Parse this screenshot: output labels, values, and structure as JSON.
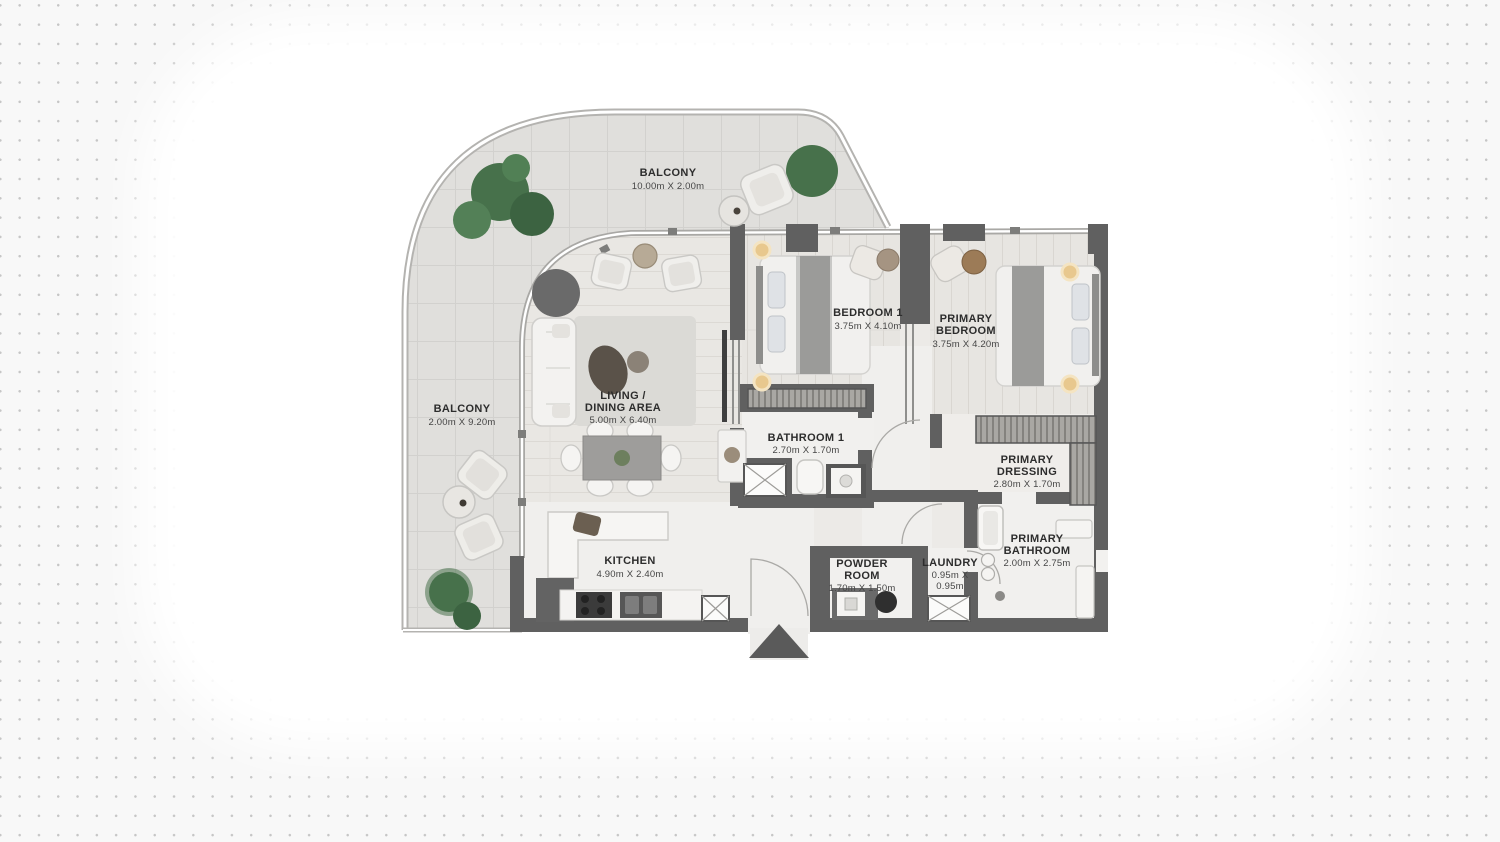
{
  "page": {
    "background_color": "#f8f8f8",
    "dot_color": "#c6c6c6",
    "canvas_color": "#ffffff"
  },
  "plan": {
    "wall_color": "#606060",
    "balcony_floor_color": "#e0dfdc",
    "interior_floor_color": "#eceae7",
    "marble_floor_color": "#f0efed",
    "plant_color": "#47714b",
    "lamp_glow_color": "#e8c88e",
    "rooms": [
      {
        "id": "balcony-top",
        "lines": [
          "BALCONY",
          "10.00m X 2.00m"
        ]
      },
      {
        "id": "balcony-left",
        "lines": [
          "BALCONY",
          "2.00m X 9.20m"
        ]
      },
      {
        "id": "living-dining",
        "lines": [
          "LIVING /",
          "DINING AREA",
          "5.00m X 6.40m"
        ]
      },
      {
        "id": "bedroom-1",
        "lines": [
          "BEDROOM 1",
          "3.75m X 4.10m"
        ]
      },
      {
        "id": "primary-bedroom",
        "lines": [
          "PRIMARY",
          "BEDROOM",
          "3.75m X 4.20m"
        ]
      },
      {
        "id": "bathroom-1",
        "lines": [
          "BATHROOM 1",
          "2.70m X 1.70m"
        ]
      },
      {
        "id": "primary-dressing",
        "lines": [
          "PRIMARY",
          "DRESSING",
          "2.80m X 1.70m"
        ]
      },
      {
        "id": "primary-bathroom",
        "lines": [
          "PRIMARY",
          "BATHROOM",
          "2.00m X 2.75m"
        ]
      },
      {
        "id": "kitchen",
        "lines": [
          "KITCHEN",
          "4.90m X 2.40m"
        ]
      },
      {
        "id": "powder-room",
        "lines": [
          "POWDER",
          "ROOM",
          "1.70m X 1.50m"
        ]
      },
      {
        "id": "laundry",
        "lines": [
          "LAUNDRY",
          "0.95m X",
          "0.95m"
        ]
      }
    ]
  }
}
